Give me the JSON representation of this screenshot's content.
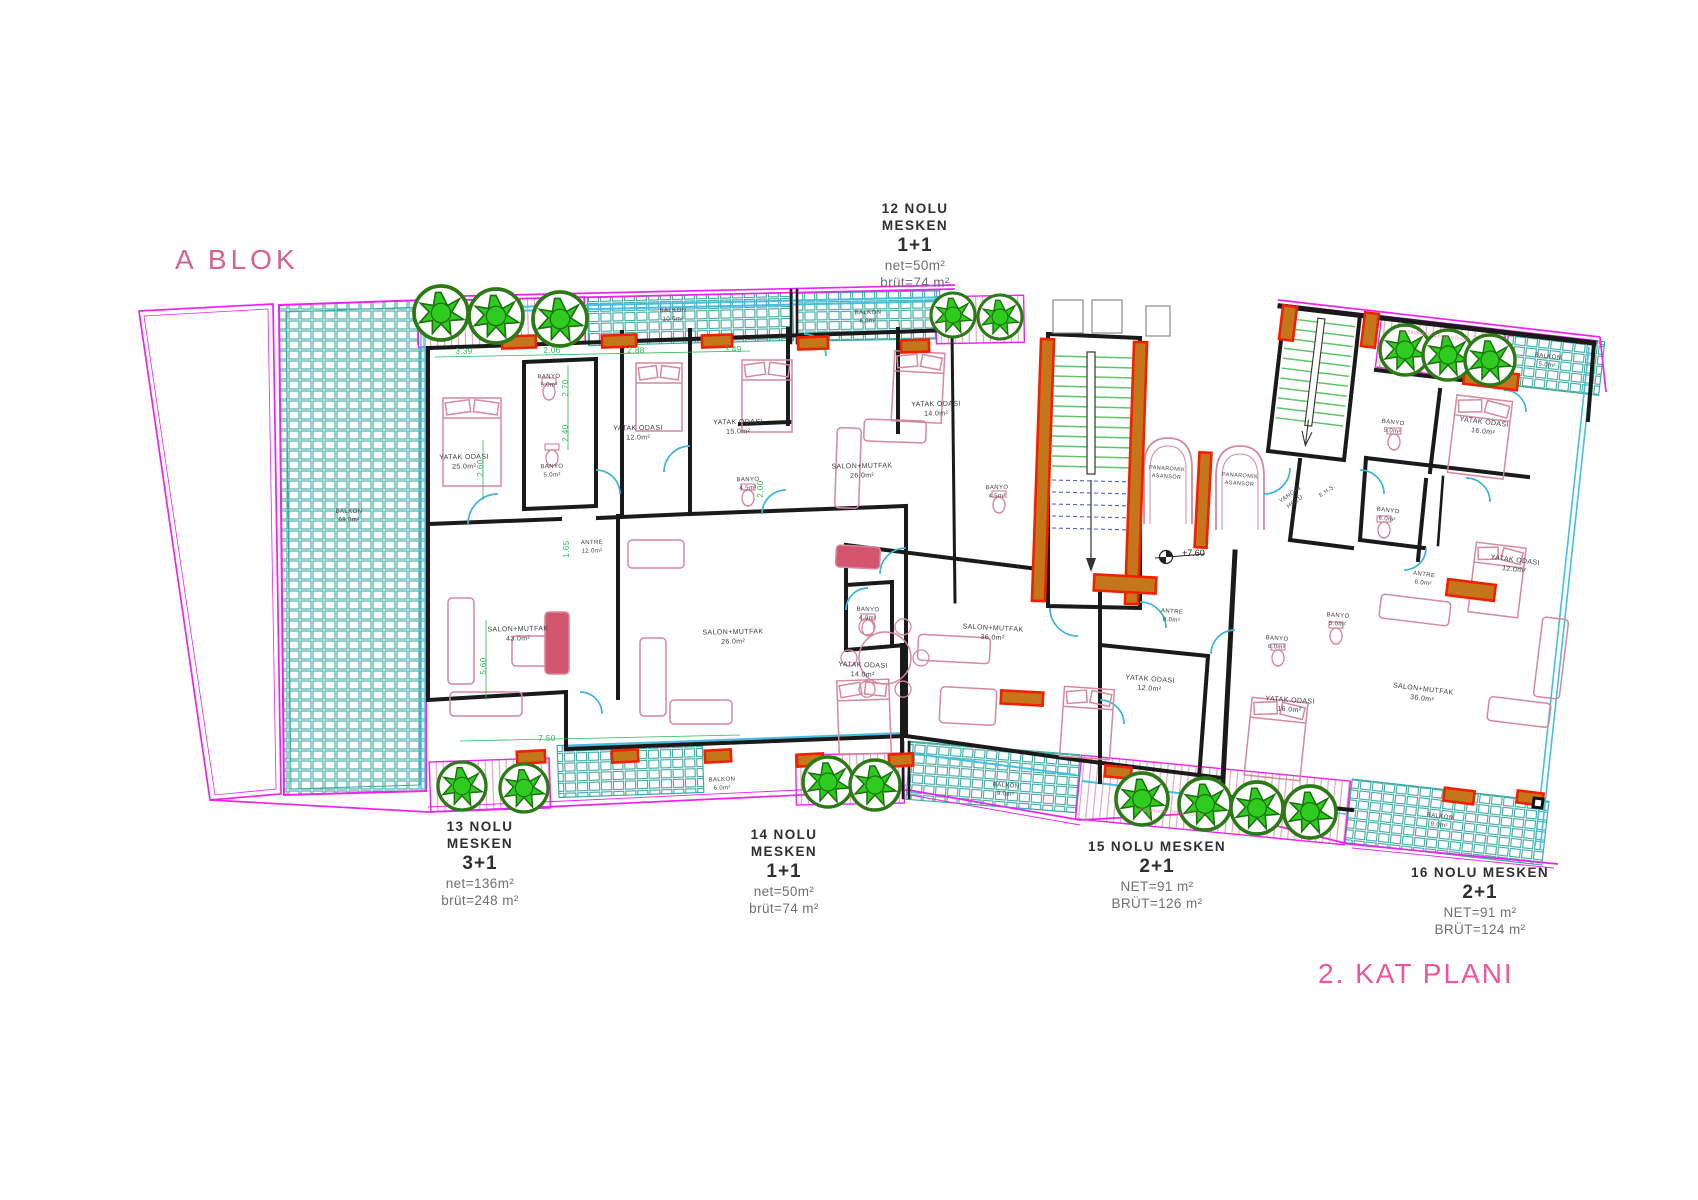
{
  "title": {
    "block": "A BLOK",
    "plan": "2. KAT PLANI"
  },
  "apartments": [
    {
      "id": "12",
      "name_line1": "12 NOLU",
      "name_line2": "MESKEN",
      "type": "1+1",
      "net": "net=50m²",
      "brut": "brüt=74 m²"
    },
    {
      "id": "13",
      "name_line1": "13 NOLU",
      "name_line2": "MESKEN",
      "type": "3+1",
      "net": "net=136m²",
      "brut": "brüt=248 m²"
    },
    {
      "id": "14",
      "name_line1": "14 NOLU",
      "name_line2": "MESKEN",
      "type": "1+1",
      "net": "net=50m²",
      "brut": "brüt=74 m²"
    },
    {
      "id": "15",
      "name": "15 NOLU MESKEN",
      "type": "2+1",
      "net": "NET=91 m²",
      "brut": "BRÜT=126 m²"
    },
    {
      "id": "16",
      "name": "16 NOLU MESKEN",
      "type": "2+1",
      "net": "NET=91 m²",
      "brut": "BRÜT=124 m²"
    }
  ],
  "plan": {
    "rooms": [
      {
        "label": "YATAK ODASI",
        "area": "25.0m²",
        "x": 464,
        "y": 459,
        "rot": -1
      },
      {
        "label": "BANYO",
        "area": "5.0m²",
        "x": 549,
        "y": 378,
        "rot": -1,
        "s": 6
      },
      {
        "label": "BANYO",
        "area": "5.0m²",
        "x": 552,
        "y": 468,
        "rot": -1,
        "s": 6
      },
      {
        "label": "YATAK ODASI",
        "area": "12.0m²",
        "x": 638,
        "y": 430,
        "rot": -1
      },
      {
        "label": "ANTRE",
        "area": "12.0m²",
        "x": 592,
        "y": 544,
        "rot": -1,
        "s": 6
      },
      {
        "label": "SALON+MUTFAK",
        "area": "43.0m²",
        "x": 518,
        "y": 631,
        "rot": -1
      },
      {
        "label": "YATAK ODASI",
        "area": "15.0m²",
        "x": 738,
        "y": 424,
        "rot": -1
      },
      {
        "label": "BANYO",
        "area": "4.5m²",
        "x": 748,
        "y": 481,
        "rot": -1,
        "s": 6
      },
      {
        "label": "SALON+MUTFAK",
        "area": "26.0m²",
        "x": 862,
        "y": 468,
        "rot": -1
      },
      {
        "label": "YATAK ODASI",
        "area": "14.0m²",
        "x": 936,
        "y": 406,
        "rot": -1
      },
      {
        "label": "BANYO",
        "area": "4.5m²",
        "x": 997,
        "y": 489,
        "rot": -1,
        "s": 6
      },
      {
        "label": "SALON+MUTFAK",
        "area": "26.0m²",
        "x": 733,
        "y": 634,
        "rot": -1
      },
      {
        "label": "BANYO",
        "area": "4.9m²",
        "x": 868,
        "y": 611,
        "rot": 2,
        "s": 6
      },
      {
        "label": "YATAK ODASI",
        "area": "14.0m²",
        "x": 863,
        "y": 667,
        "rot": 2
      },
      {
        "label": "SALON+MUTFAK",
        "area": "36.0m²",
        "x": 993,
        "y": 630,
        "rot": 3
      },
      {
        "label": "ANTRE",
        "area": "8.0m²",
        "x": 1172,
        "y": 613,
        "rot": 4,
        "s": 6
      },
      {
        "label": "YATAK ODASI",
        "area": "12.0m²",
        "x": 1150,
        "y": 681,
        "rot": 4
      },
      {
        "label": "BANYO",
        "area": "6.0m²",
        "x": 1277,
        "y": 640,
        "rot": 4,
        "s": 6
      },
      {
        "label": "BANYO",
        "area": "5.0m²",
        "x": 1338,
        "y": 617,
        "rot": 4,
        "s": 6
      },
      {
        "label": "YATAK ODASI",
        "area": "16.0m²",
        "x": 1290,
        "y": 702,
        "rot": 4
      },
      {
        "label": "BANYO",
        "area": "5.0m²",
        "x": 1393,
        "y": 424,
        "rot": 7,
        "s": 6
      },
      {
        "label": "YATAK ODASI",
        "area": "16.0m²",
        "x": 1484,
        "y": 424,
        "rot": 7
      },
      {
        "label": "BANYO",
        "area": "6.0m²",
        "x": 1388,
        "y": 512,
        "rot": 7,
        "s": 6
      },
      {
        "label": "YATAK ODASI",
        "area": "12.0m²",
        "x": 1515,
        "y": 562,
        "rot": 7
      },
      {
        "label": "ANTRE",
        "area": "8.0m²",
        "x": 1424,
        "y": 576,
        "rot": 7,
        "s": 6
      },
      {
        "label": "SALON+MUTFAK",
        "area": "36.0m²",
        "x": 1423,
        "y": 691,
        "rot": 7
      },
      {
        "label": "BALKON",
        "area": "69.0m²",
        "x": 349,
        "y": 513,
        "s": 6
      },
      {
        "label": "BALKON",
        "area": "10.0m²",
        "x": 673,
        "y": 312,
        "rot": -1,
        "s": 6
      },
      {
        "label": "BALKON",
        "area": "6.0m²",
        "x": 868,
        "y": 314,
        "rot": -1,
        "s": 6
      },
      {
        "label": "BALKON",
        "area": "5.0m²",
        "x": 1548,
        "y": 358,
        "rot": 7,
        "s": 6
      },
      {
        "label": "BALKON",
        "area": "6.0m²",
        "x": 722,
        "y": 781,
        "rot": -2,
        "s": 6
      },
      {
        "label": "BALKON",
        "area": "9.0m²",
        "x": 1006,
        "y": 787,
        "rot": 4,
        "s": 6
      },
      {
        "label": "BALKON",
        "area": "9.0m²",
        "x": 1440,
        "y": 818,
        "rot": 7,
        "s": 6
      }
    ],
    "features": [
      {
        "lines": [
          "PANAROMİK",
          "ASANSÖR"
        ],
        "x": 1167,
        "y": 470,
        "rot": 4,
        "s": 5.5
      },
      {
        "lines": [
          "PANAROMİK",
          "ASANSÖR"
        ],
        "x": 1240,
        "y": 477,
        "rot": 4,
        "s": 5.5
      },
      {
        "lines": [
          "YANGIN",
          "HOLÜ"
        ],
        "x": 1291,
        "y": 496,
        "rot": -35,
        "s": 6
      },
      {
        "lines": [
          "E.H.Ş."
        ],
        "x": 1328,
        "y": 492,
        "rot": -35,
        "s": 5.5
      }
    ],
    "dimensions": [
      {
        "text": "3.39",
        "x": 464,
        "y": 354
      },
      {
        "text": "2.06",
        "x": 552,
        "y": 353
      },
      {
        "text": "2.88",
        "x": 636,
        "y": 353
      },
      {
        "text": "3.49",
        "x": 733,
        "y": 352
      },
      {
        "text": "7.50",
        "x": 547,
        "y": 741
      },
      {
        "text": "2.70",
        "x": 568,
        "y": 388,
        "rot": -90
      },
      {
        "text": "2.40",
        "x": 568,
        "y": 433,
        "rot": -90
      },
      {
        "text": "2.60",
        "x": 483,
        "y": 468,
        "rot": -90
      },
      {
        "text": "1.65",
        "x": 569,
        "y": 549,
        "rot": -90
      },
      {
        "text": "2.00",
        "x": 763,
        "y": 489,
        "rot": -90
      },
      {
        "text": "5.60",
        "x": 486,
        "y": 666,
        "rot": -90
      }
    ],
    "elevation": {
      "text": "+7.60",
      "x": 1182,
      "y": 556
    },
    "planter_notes": [
      {
        "text": "DEKORATİF ÇELİK GÖLGE",
        "x": 1436,
        "y": 337,
        "rot": 7
      },
      {
        "text": "DEKORATİF ÇELİK GÖLGE",
        "x": 1172,
        "y": 814,
        "rot": 5
      }
    ],
    "trees": [
      {
        "x": 441,
        "y": 313,
        "r": 27
      },
      {
        "x": 496,
        "y": 316,
        "r": 27
      },
      {
        "x": 560,
        "y": 319,
        "r": 27
      },
      {
        "x": 953,
        "y": 315,
        "r": 22
      },
      {
        "x": 1000,
        "y": 317,
        "r": 22
      },
      {
        "x": 1405,
        "y": 350,
        "r": 25
      },
      {
        "x": 1448,
        "y": 355,
        "r": 25
      },
      {
        "x": 1490,
        "y": 360,
        "r": 25
      },
      {
        "x": 462,
        "y": 786,
        "r": 24
      },
      {
        "x": 524,
        "y": 788,
        "r": 24
      },
      {
        "x": 828,
        "y": 782,
        "r": 25
      },
      {
        "x": 875,
        "y": 785,
        "r": 25
      },
      {
        "x": 1142,
        "y": 799,
        "r": 26
      },
      {
        "x": 1205,
        "y": 804,
        "r": 26
      },
      {
        "x": 1257,
        "y": 808,
        "r": 26
      },
      {
        "x": 1310,
        "y": 812,
        "r": 26
      }
    ],
    "columns": [
      {
        "x": 519,
        "y": 342,
        "w": 34,
        "h": 12,
        "rot": -2
      },
      {
        "x": 619,
        "y": 341,
        "w": 34,
        "h": 12,
        "rot": -2
      },
      {
        "x": 717,
        "y": 341,
        "w": 30,
        "h": 12,
        "rot": -2
      },
      {
        "x": 813,
        "y": 343,
        "w": 30,
        "h": 12,
        "rot": -2
      },
      {
        "x": 915,
        "y": 346,
        "w": 28,
        "h": 12,
        "rot": -2
      },
      {
        "x": 1288,
        "y": 323,
        "w": 14,
        "h": 34,
        "rot": 7
      },
      {
        "x": 1370,
        "y": 330,
        "w": 14,
        "h": 34,
        "rot": 7
      },
      {
        "x": 1491,
        "y": 379,
        "w": 54,
        "h": 16,
        "rot": 7
      },
      {
        "x": 1043,
        "y": 470,
        "w": 13,
        "h": 262,
        "rot": 2
      },
      {
        "x": 1136,
        "y": 473,
        "w": 13,
        "h": 262,
        "rot": 2
      },
      {
        "x": 1203,
        "y": 500,
        "w": 12,
        "h": 95,
        "rot": 3
      },
      {
        "x": 1125,
        "y": 584,
        "w": 62,
        "h": 16,
        "rot": 3
      },
      {
        "x": 1471,
        "y": 590,
        "w": 48,
        "h": 16,
        "rot": 7
      },
      {
        "x": 1022,
        "y": 698,
        "w": 42,
        "h": 13,
        "rot": 3
      },
      {
        "x": 531,
        "y": 757,
        "w": 28,
        "h": 12,
        "rot": -3
      },
      {
        "x": 625,
        "y": 756,
        "w": 26,
        "h": 12,
        "rot": -3
      },
      {
        "x": 718,
        "y": 756,
        "w": 26,
        "h": 12,
        "rot": -3
      },
      {
        "x": 810,
        "y": 760,
        "w": 26,
        "h": 12,
        "rot": -3
      },
      {
        "x": 901,
        "y": 760,
        "w": 24,
        "h": 12,
        "rot": -3
      },
      {
        "x": 1118,
        "y": 772,
        "w": 26,
        "h": 11,
        "rot": 5
      },
      {
        "x": 1459,
        "y": 796,
        "w": 30,
        "h": 13,
        "rot": 7
      },
      {
        "x": 1530,
        "y": 798,
        "w": 26,
        "h": 12,
        "rot": 7
      }
    ],
    "colors": {
      "boundary_magenta": "#ee22ee",
      "tile_teal": "#3fa9a2",
      "window_cyan": "#44bfe4",
      "wall_black": "#1a1a1a",
      "furniture_pink": "#d4899c",
      "tree_green": "#2ecc1e",
      "tree_ring": "#2c7a16",
      "column_red": "#f02000",
      "column_orange": "#c4761b",
      "dimension_green": "#2db85a",
      "block_title_pink": "#d4638f",
      "plan_title_pink": "#f0559b",
      "stair_tread_green": "#5fc46a"
    }
  }
}
